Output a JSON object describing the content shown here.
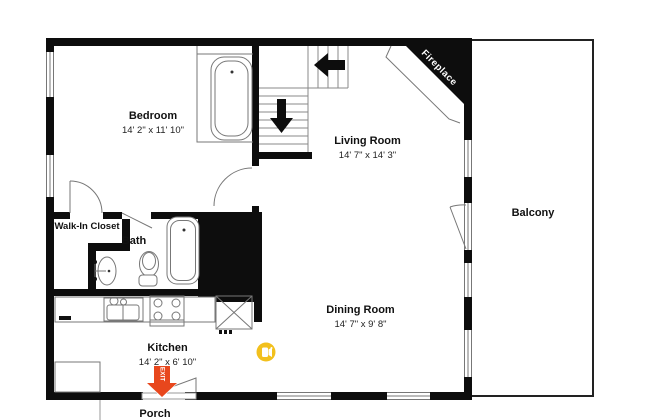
{
  "plan": {
    "rooms": {
      "bedroom": {
        "name": "Bedroom",
        "dims": "14' 2\" x 11' 10\""
      },
      "living_room": {
        "name": "Living Room",
        "dims": "14' 7\" x 14' 3\""
      },
      "dining_room": {
        "name": "Dining Room",
        "dims": "14' 7\" x 9' 8\""
      },
      "kitchen": {
        "name": "Kitchen",
        "dims": "14' 2\" x 6' 10\""
      },
      "bath": {
        "name": "Bath"
      },
      "walk_in_closet": {
        "name": "Walk-In Closet"
      },
      "balcony": {
        "name": "Balcony"
      },
      "porch": {
        "name": "Porch"
      },
      "fireplace": {
        "name": "Fireplace"
      }
    },
    "markers": {
      "exit_label": "EXIT",
      "exit_icon": "exit-down-arrow-icon",
      "camera_icon": "video-camera-icon"
    },
    "colors": {
      "wall": "#0d0d0d",
      "line_gray": "#777777",
      "exit_red": "#e8471d",
      "camera_yellow": "#f2c01d"
    }
  }
}
